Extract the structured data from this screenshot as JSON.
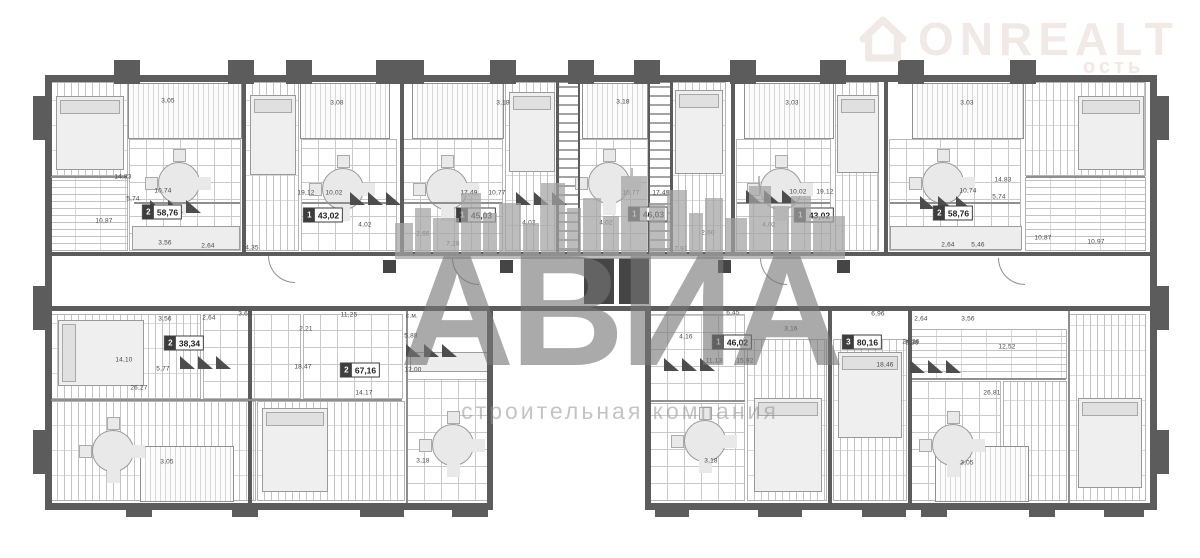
{
  "logo": {
    "brand": "ONREALT",
    "tagline": "ость"
  },
  "watermark": {
    "title": "АВИА",
    "subtitle": "строительная компания"
  },
  "colors": {
    "wall": "#5c5c5c",
    "watermark_gray": "#7a7a7a",
    "logo_tint": "#f0e9e5"
  },
  "plan": {
    "badges": [
      {
        "r": "2",
        "a": "58,76",
        "x": 162,
        "y": 212
      },
      {
        "r": "1",
        "a": "43,02",
        "x": 323,
        "y": 215
      },
      {
        "r": "1",
        "a": "45,03",
        "x": 476,
        "y": 215
      },
      {
        "r": "1",
        "a": "46,03",
        "x": 648,
        "y": 214
      },
      {
        "r": "1",
        "a": "43,02",
        "x": 814,
        "y": 215
      },
      {
        "r": "2",
        "a": "58,76",
        "x": 953,
        "y": 213
      },
      {
        "r": "2",
        "a": "38,34",
        "x": 184,
        "y": 343
      },
      {
        "r": "2",
        "a": "67,16",
        "x": 360,
        "y": 370
      },
      {
        "r": "1",
        "a": "46,02",
        "x": 732,
        "y": 342
      },
      {
        "r": "3",
        "a": "80,16",
        "x": 862,
        "y": 342
      }
    ],
    "room_labels": [
      {
        "t": "3,05",
        "x": 168,
        "y": 101
      },
      {
        "t": "3,08",
        "x": 337,
        "y": 103
      },
      {
        "t": "3,18",
        "x": 503,
        "y": 103
      },
      {
        "t": "3,18",
        "x": 623,
        "y": 102
      },
      {
        "t": "3,03",
        "x": 792,
        "y": 103
      },
      {
        "t": "3,03",
        "x": 967,
        "y": 103
      },
      {
        "t": "14,83",
        "x": 123,
        "y": 177
      },
      {
        "t": "10,74",
        "x": 163,
        "y": 191
      },
      {
        "t": "5,74",
        "x": 133,
        "y": 199
      },
      {
        "t": "10,87",
        "x": 104,
        "y": 221
      },
      {
        "t": "3,56",
        "x": 165,
        "y": 243
      },
      {
        "t": "2,64",
        "x": 208,
        "y": 246
      },
      {
        "t": "4,35",
        "x": 252,
        "y": 248
      },
      {
        "t": "19,12",
        "x": 306,
        "y": 193
      },
      {
        "t": "10,02",
        "x": 334,
        "y": 193
      },
      {
        "t": "4,02",
        "x": 365,
        "y": 225
      },
      {
        "t": "17,49",
        "x": 469,
        "y": 193
      },
      {
        "t": "10,77",
        "x": 497,
        "y": 193
      },
      {
        "t": "2,66",
        "x": 423,
        "y": 234
      },
      {
        "t": "7,28",
        "x": 453,
        "y": 244
      },
      {
        "t": "4,02",
        "x": 529,
        "y": 223
      },
      {
        "t": "10,77",
        "x": 631,
        "y": 193
      },
      {
        "t": "17,49",
        "x": 661,
        "y": 193
      },
      {
        "t": "4,02",
        "x": 606,
        "y": 223
      },
      {
        "t": "2,60",
        "x": 708,
        "y": 233
      },
      {
        "t": "7,91",
        "x": 681,
        "y": 249
      },
      {
        "t": "4,02",
        "x": 769,
        "y": 225
      },
      {
        "t": "10,02",
        "x": 798,
        "y": 192
      },
      {
        "t": "19,12",
        "x": 825,
        "y": 192
      },
      {
        "t": "10,74",
        "x": 968,
        "y": 191
      },
      {
        "t": "14,83",
        "x": 1003,
        "y": 180
      },
      {
        "t": "5,74",
        "x": 999,
        "y": 197
      },
      {
        "t": "2,64",
        "x": 948,
        "y": 245
      },
      {
        "t": "5,46",
        "x": 978,
        "y": 245
      },
      {
        "t": "10,87",
        "x": 1043,
        "y": 238
      },
      {
        "t": "10,97",
        "x": 1096,
        "y": 242
      },
      {
        "t": "3,56",
        "x": 165,
        "y": 319
      },
      {
        "t": "2,64",
        "x": 209,
        "y": 318
      },
      {
        "t": "3,62",
        "x": 245,
        "y": 314
      },
      {
        "t": "14,10",
        "x": 124,
        "y": 360
      },
      {
        "t": "5,77",
        "x": 163,
        "y": 369
      },
      {
        "t": "26,27",
        "x": 139,
        "y": 388
      },
      {
        "t": "3,05",
        "x": 167,
        "y": 462
      },
      {
        "t": "11,25",
        "x": 349,
        "y": 315
      },
      {
        "t": "с.м.",
        "x": 412,
        "y": 316
      },
      {
        "t": "2,21",
        "x": 306,
        "y": 329
      },
      {
        "t": "5,88",
        "x": 411,
        "y": 336
      },
      {
        "t": "18,47",
        "x": 303,
        "y": 367
      },
      {
        "t": "12,00",
        "x": 413,
        "y": 370
      },
      {
        "t": "14,17",
        "x": 364,
        "y": 393
      },
      {
        "t": "3,18",
        "x": 423,
        "y": 461
      },
      {
        "t": "6,45",
        "x": 733,
        "y": 313
      },
      {
        "t": "6,96",
        "x": 878,
        "y": 314
      },
      {
        "t": "3,16",
        "x": 791,
        "y": 329
      },
      {
        "t": "4,16",
        "x": 686,
        "y": 337
      },
      {
        "t": "11,13",
        "x": 714,
        "y": 361
      },
      {
        "t": "15,92",
        "x": 745,
        "y": 361
      },
      {
        "t": "18,46",
        "x": 885,
        "y": 365
      },
      {
        "t": "24,36",
        "x": 911,
        "y": 342
      },
      {
        "t": "3,18",
        "x": 711,
        "y": 461
      },
      {
        "t": "2,64",
        "x": 921,
        "y": 319
      },
      {
        "t": "3,56",
        "x": 968,
        "y": 319
      },
      {
        "t": "6,38",
        "x": 912,
        "y": 343
      },
      {
        "t": "12,52",
        "x": 1007,
        "y": 347
      },
      {
        "t": "26,81",
        "x": 992,
        "y": 393
      },
      {
        "t": "3,05",
        "x": 967,
        "y": 463
      }
    ]
  }
}
